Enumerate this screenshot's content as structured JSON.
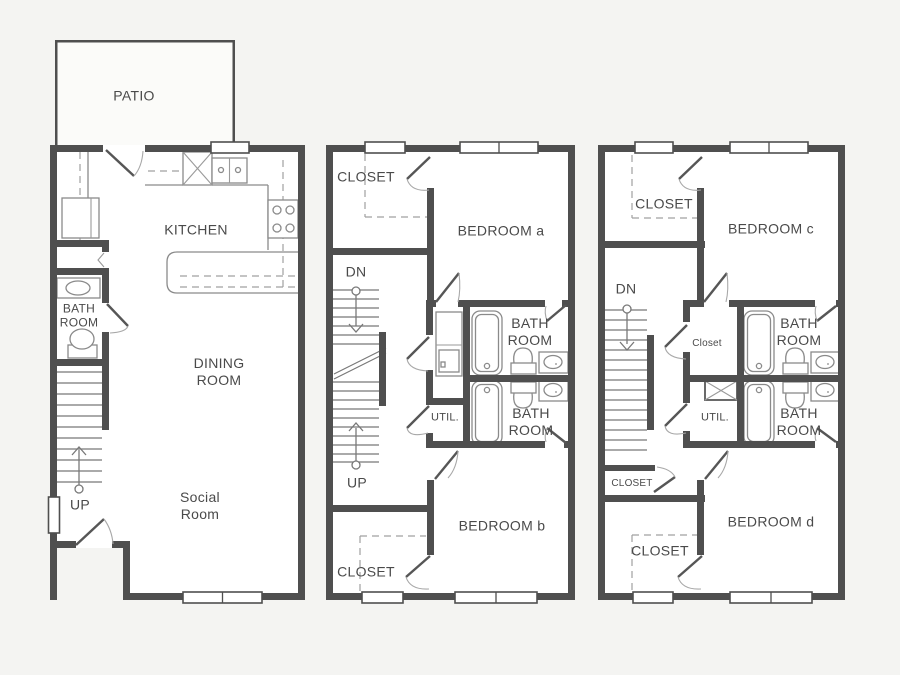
{
  "title": "Three-story townhouse floor plans",
  "colors": {
    "wall": "#4f4f4f",
    "background": "#f4f4f2",
    "floor_fill": "#ffffff",
    "fixture_line": "#8a8a8a",
    "dashed_line": "#a0a0a0",
    "label_text": "#4a4a4a"
  },
  "floors": [
    {
      "id": "first-floor",
      "rooms": {
        "patio": "PATIO",
        "kitchen": "KITCHEN",
        "bathroom": "BATH ROOM",
        "dining_room": "DINING ROOM",
        "social_room": "Social Room"
      },
      "stairs": {
        "up_label": "UP"
      }
    },
    {
      "id": "second-floor",
      "rooms": {
        "closet_top": "CLOSET",
        "bedroom_a": "BEDROOM a",
        "bathroom_upper": "BATH ROOM",
        "utility": "UTIL.",
        "bathroom_lower": "BATH ROOM",
        "bedroom_b": "BEDROOM b",
        "closet_bottom": "CLOSET"
      },
      "stairs": {
        "down_label": "DN",
        "up_label": "UP"
      }
    },
    {
      "id": "third-floor",
      "rooms": {
        "closet_top": "CLOSET",
        "bedroom_c": "BEDROOM c",
        "closet_mid": "Closet",
        "bathroom_upper": "BATH ROOM",
        "utility": "UTIL.",
        "bathroom_lower": "BATH ROOM",
        "closet_stairs": "CLOSET",
        "bedroom_d": "BEDROOM d",
        "closet_bottom": "CLOSET"
      },
      "stairs": {
        "down_label": "DN"
      }
    }
  ]
}
